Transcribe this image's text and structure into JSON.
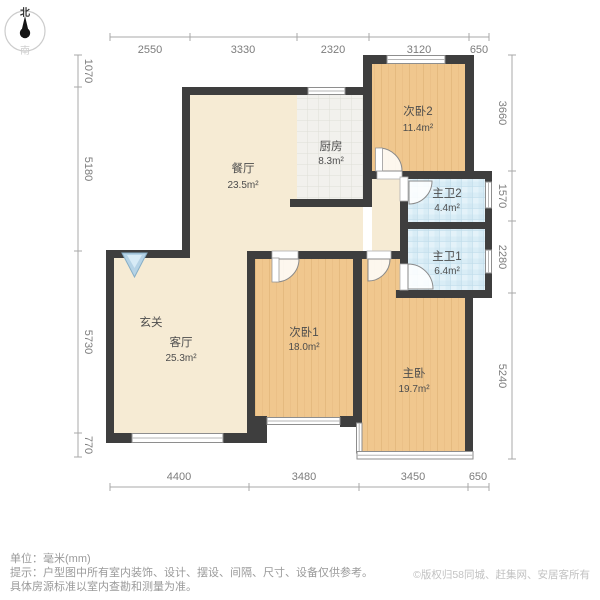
{
  "compass": {
    "north": "北",
    "south": "南"
  },
  "dimensions": {
    "unit_note": "毫米(mm)",
    "top": [
      "2550",
      "3330",
      "2320",
      "3120",
      "650"
    ],
    "bottom": [
      "4400",
      "3480",
      "3450",
      "650"
    ],
    "left": [
      "1070",
      "5180",
      "5730",
      "770"
    ],
    "right": [
      "3660",
      "1570",
      "2280",
      "5240"
    ]
  },
  "rooms": {
    "dining": {
      "name": "餐厅",
      "area": "23.5m²"
    },
    "kitchen": {
      "name": "厨房",
      "area": "8.3m²"
    },
    "bedroom2": {
      "name": "次卧2",
      "area": "11.4m²"
    },
    "bath2": {
      "name": "主卫2",
      "area": "4.4m²"
    },
    "bath1": {
      "name": "主卫1",
      "area": "6.4m²"
    },
    "entry": {
      "name": "玄关"
    },
    "living": {
      "name": "客厅",
      "area": "25.3m²"
    },
    "bedroom1": {
      "name": "次卧1",
      "area": "18.0m²"
    },
    "master": {
      "name": "主卧",
      "area": "19.7m²"
    }
  },
  "footer": {
    "unit_line": "单位：毫米(mm)",
    "tip_line1": "提示：户型图中所有室内装饰、设计、摆设、间隔、尺寸、设备仅供参考。",
    "tip_line2": "具体房源标准以室内查勘和测量为准。",
    "copyright": "©版权归58同城、赶集网、安居客所有"
  },
  "colors": {
    "wall": "#3e3e3e",
    "wood_floor": "#f0c78e",
    "kitchen_tile": "#f2f1ed",
    "bath_tile": "#d9edf6",
    "cream_floor": "#f6ebd4",
    "entry_arrow": "#b5d3e6"
  }
}
